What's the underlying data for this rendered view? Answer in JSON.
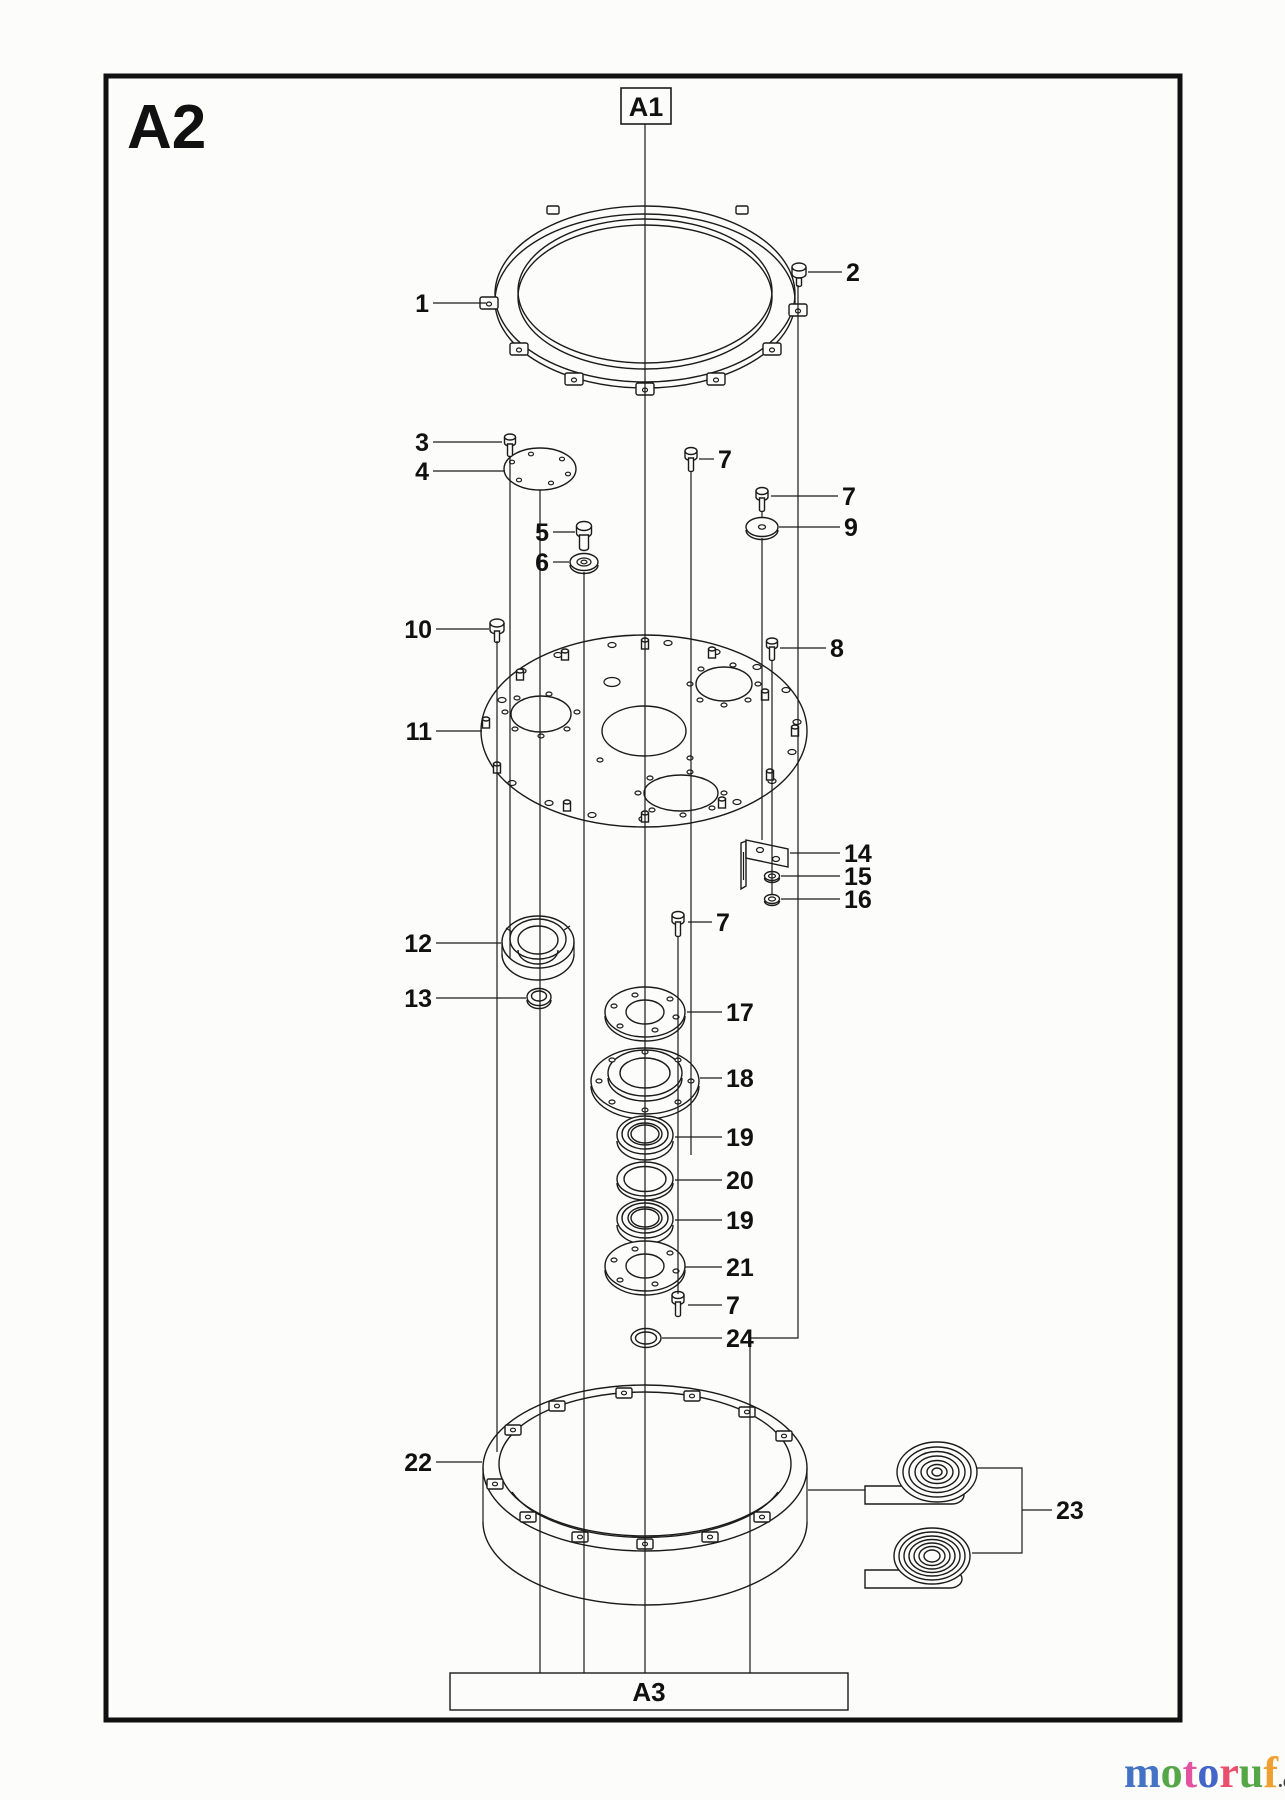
{
  "page": {
    "sheet_label": "A2",
    "ref_top": "A1",
    "ref_bottom": "A3"
  },
  "callouts": [
    {
      "label": "1"
    },
    {
      "label": "2"
    },
    {
      "label": "3"
    },
    {
      "label": "4"
    },
    {
      "label": "5"
    },
    {
      "label": "6"
    },
    {
      "label": "7"
    },
    {
      "label": "7"
    },
    {
      "label": "9"
    },
    {
      "label": "10"
    },
    {
      "label": "8"
    },
    {
      "label": "11"
    },
    {
      "label": "14"
    },
    {
      "label": "15"
    },
    {
      "label": "16"
    },
    {
      "label": "7"
    },
    {
      "label": "12"
    },
    {
      "label": "13"
    },
    {
      "label": "17"
    },
    {
      "label": "18"
    },
    {
      "label": "19"
    },
    {
      "label": "20"
    },
    {
      "label": "19"
    },
    {
      "label": "21"
    },
    {
      "label": "7"
    },
    {
      "label": "24"
    },
    {
      "label": "22"
    },
    {
      "label": "23"
    }
  ],
  "logo": {
    "letters": [
      "m",
      "o",
      "t",
      "o",
      "r",
      "u",
      "f"
    ],
    "colors": [
      "#4472c4",
      "#55a646",
      "#e353a2",
      "#4464c8",
      "#e8506e",
      "#55a646",
      "#f0a030"
    ],
    "tld": ".de",
    "tld_color": "#444444"
  },
  "colors": {
    "line": "#1b1b1b",
    "background": "#fcfcfa"
  }
}
